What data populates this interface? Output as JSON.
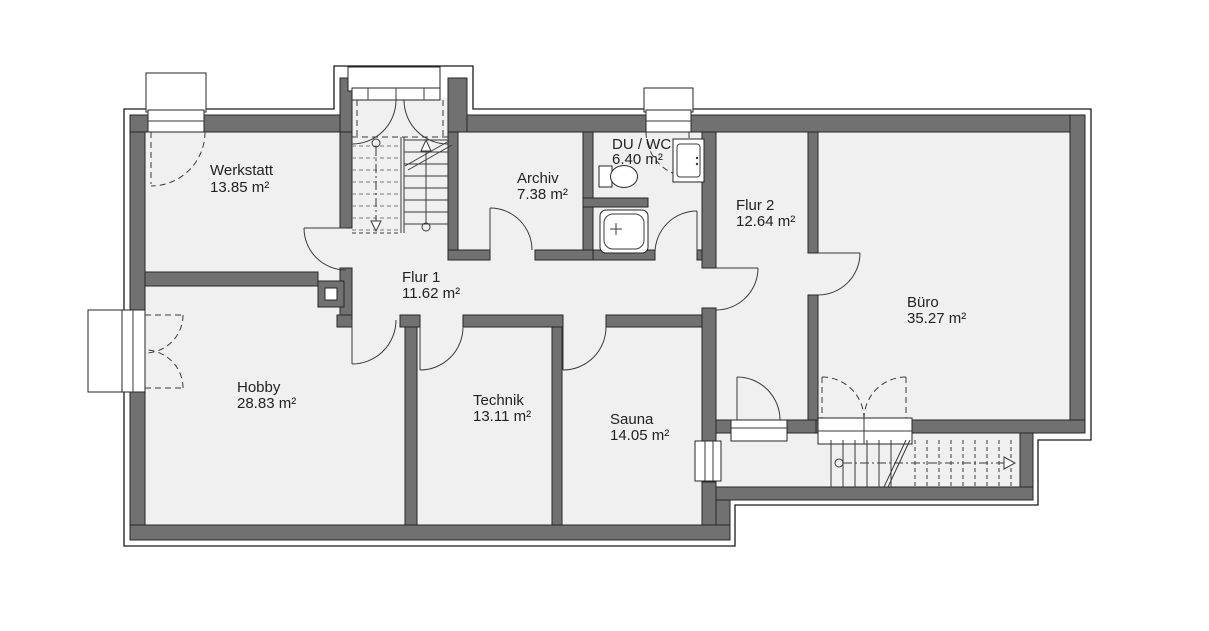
{
  "plan": {
    "type": "basement-floor-plan",
    "colors": {
      "wall": "#717171",
      "floor": "#f0f0f0",
      "background": "#ffffff",
      "line": "#262626",
      "text": "#222222"
    },
    "rooms": [
      {
        "name": "Werkstatt",
        "area": "13.85 m²"
      },
      {
        "name": "Archiv",
        "area": "7.38 m²"
      },
      {
        "name": "DU / WC",
        "area": "6.40 m²"
      },
      {
        "name": "Flur 2",
        "area": "12.64 m²"
      },
      {
        "name": "Büro",
        "area": "35.27 m²"
      },
      {
        "name": "Flur 1",
        "area": "11.62 m²"
      },
      {
        "name": "Hobby",
        "area": "28.83 m²"
      },
      {
        "name": "Technik",
        "area": "13.11 m²"
      },
      {
        "name": "Sauna",
        "area": "14.05 m²"
      }
    ]
  }
}
